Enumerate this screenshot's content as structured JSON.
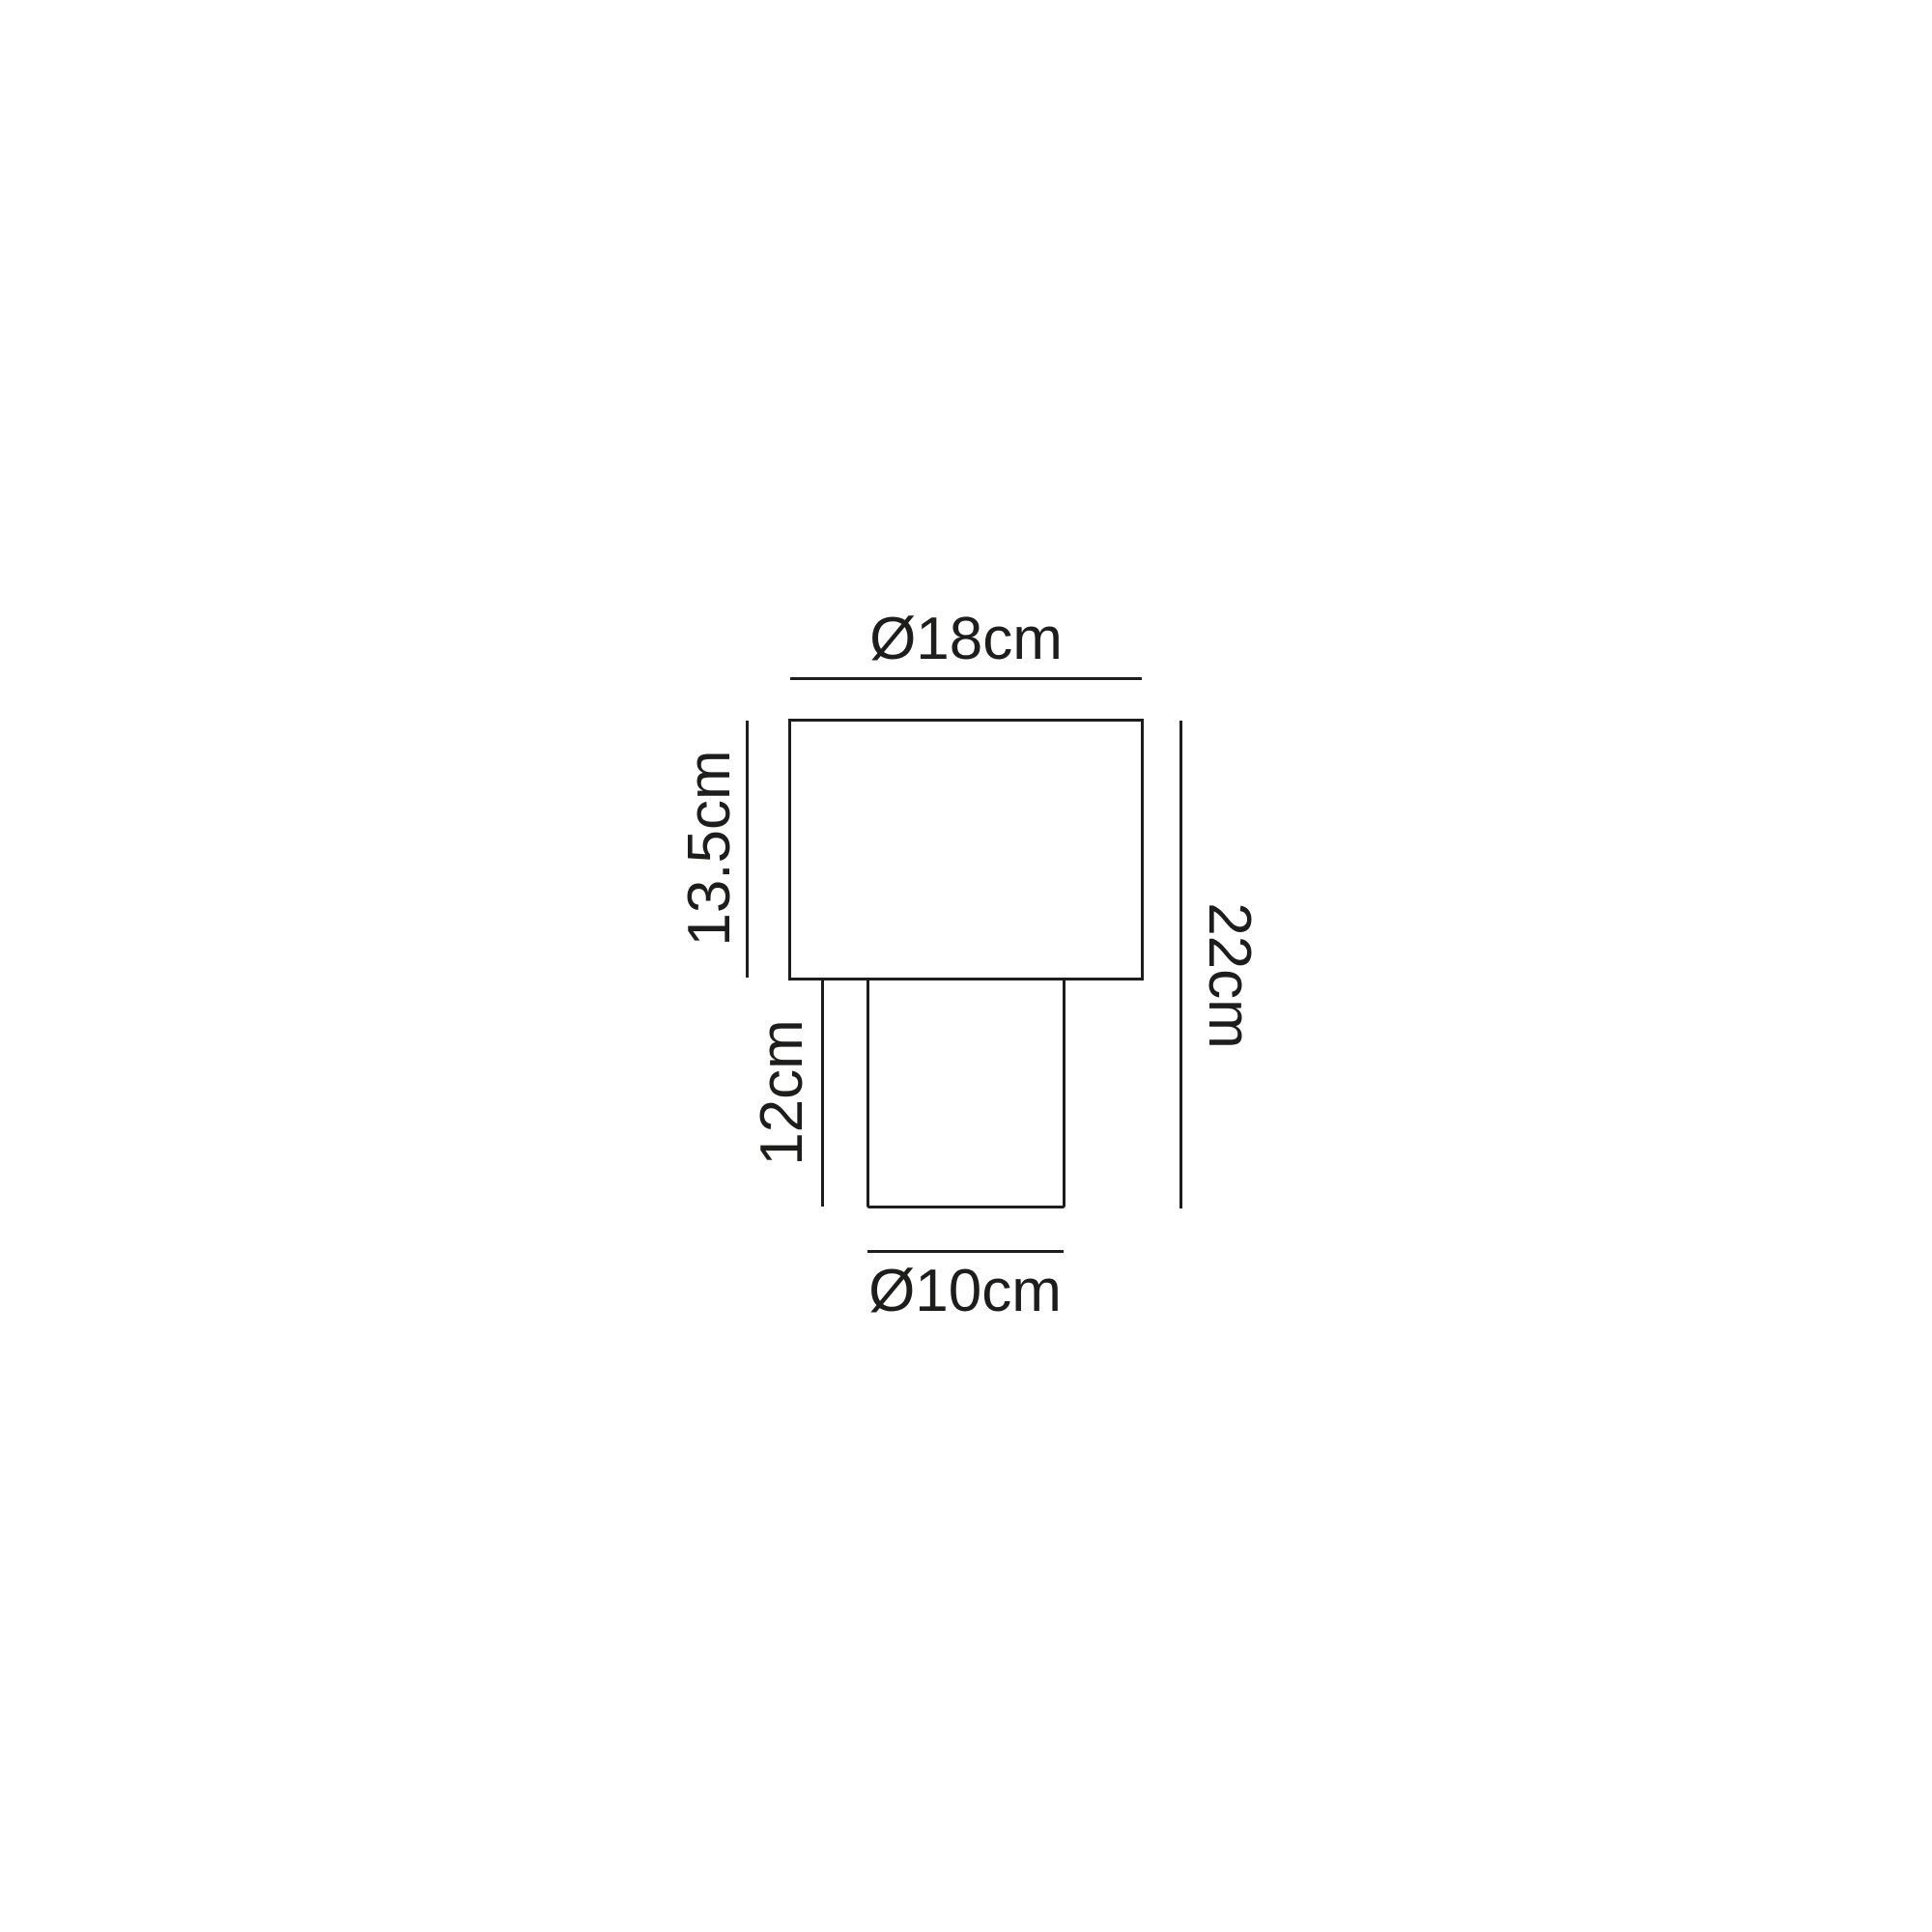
{
  "diagram": {
    "type": "product-dimension-drawing",
    "subject": "table-lamp-front-elevation",
    "line_color": "#1d1d1b",
    "background_color": "#ffffff",
    "labels": {
      "shade_diameter": "Ø18cm",
      "shade_height": "13.5cm",
      "base_height": "12cm",
      "total_height": "22cm",
      "base_diameter": "Ø10cm"
    }
  }
}
